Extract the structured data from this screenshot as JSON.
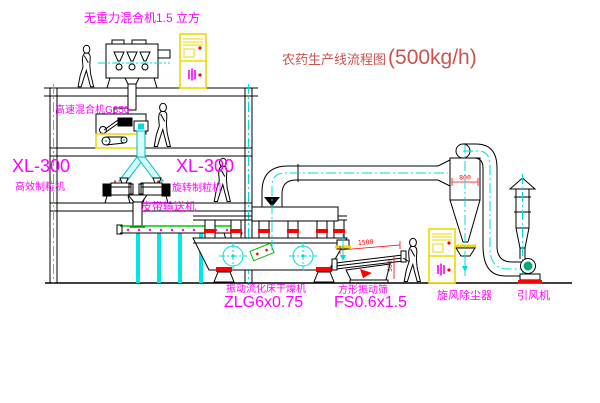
{
  "title": {
    "text": "农药生产线流程图",
    "capacity": "(500kg/h)"
  },
  "labels": {
    "gravityless_mixer": "无重力混合机1.5 立方",
    "high_speed_mixer": "高速混合机G350",
    "granulator_left_model": "XL-300",
    "granulator_left_name": "高效制粒机",
    "granulator_right_model": "XL-300",
    "granulator_right_name": "旋转制粒机",
    "belt_conveyor": "皮带输送机",
    "fluid_bed_dryer_name": "振动流化床干燥机",
    "fluid_bed_dryer_model": "ZLG6x0.75",
    "vibrating_screen_name": "方形振动筛",
    "vibrating_screen_model": "FS0.6x1.5",
    "cyclone": "旋风除尘器",
    "induced_draft_fan": "引风机"
  },
  "dimensions": {
    "cyclone_diameter": "800",
    "screen_length": "1500",
    "screen_height": "500"
  },
  "colors": {
    "label": "#ff00ff",
    "title": "#c85450",
    "line": "#000000",
    "centerline": "#00dddd",
    "panel_yellow": "#f0d800",
    "alert_red": "#ff0000",
    "belt_green": "#00cc00",
    "fan_green": "#00aa77"
  }
}
